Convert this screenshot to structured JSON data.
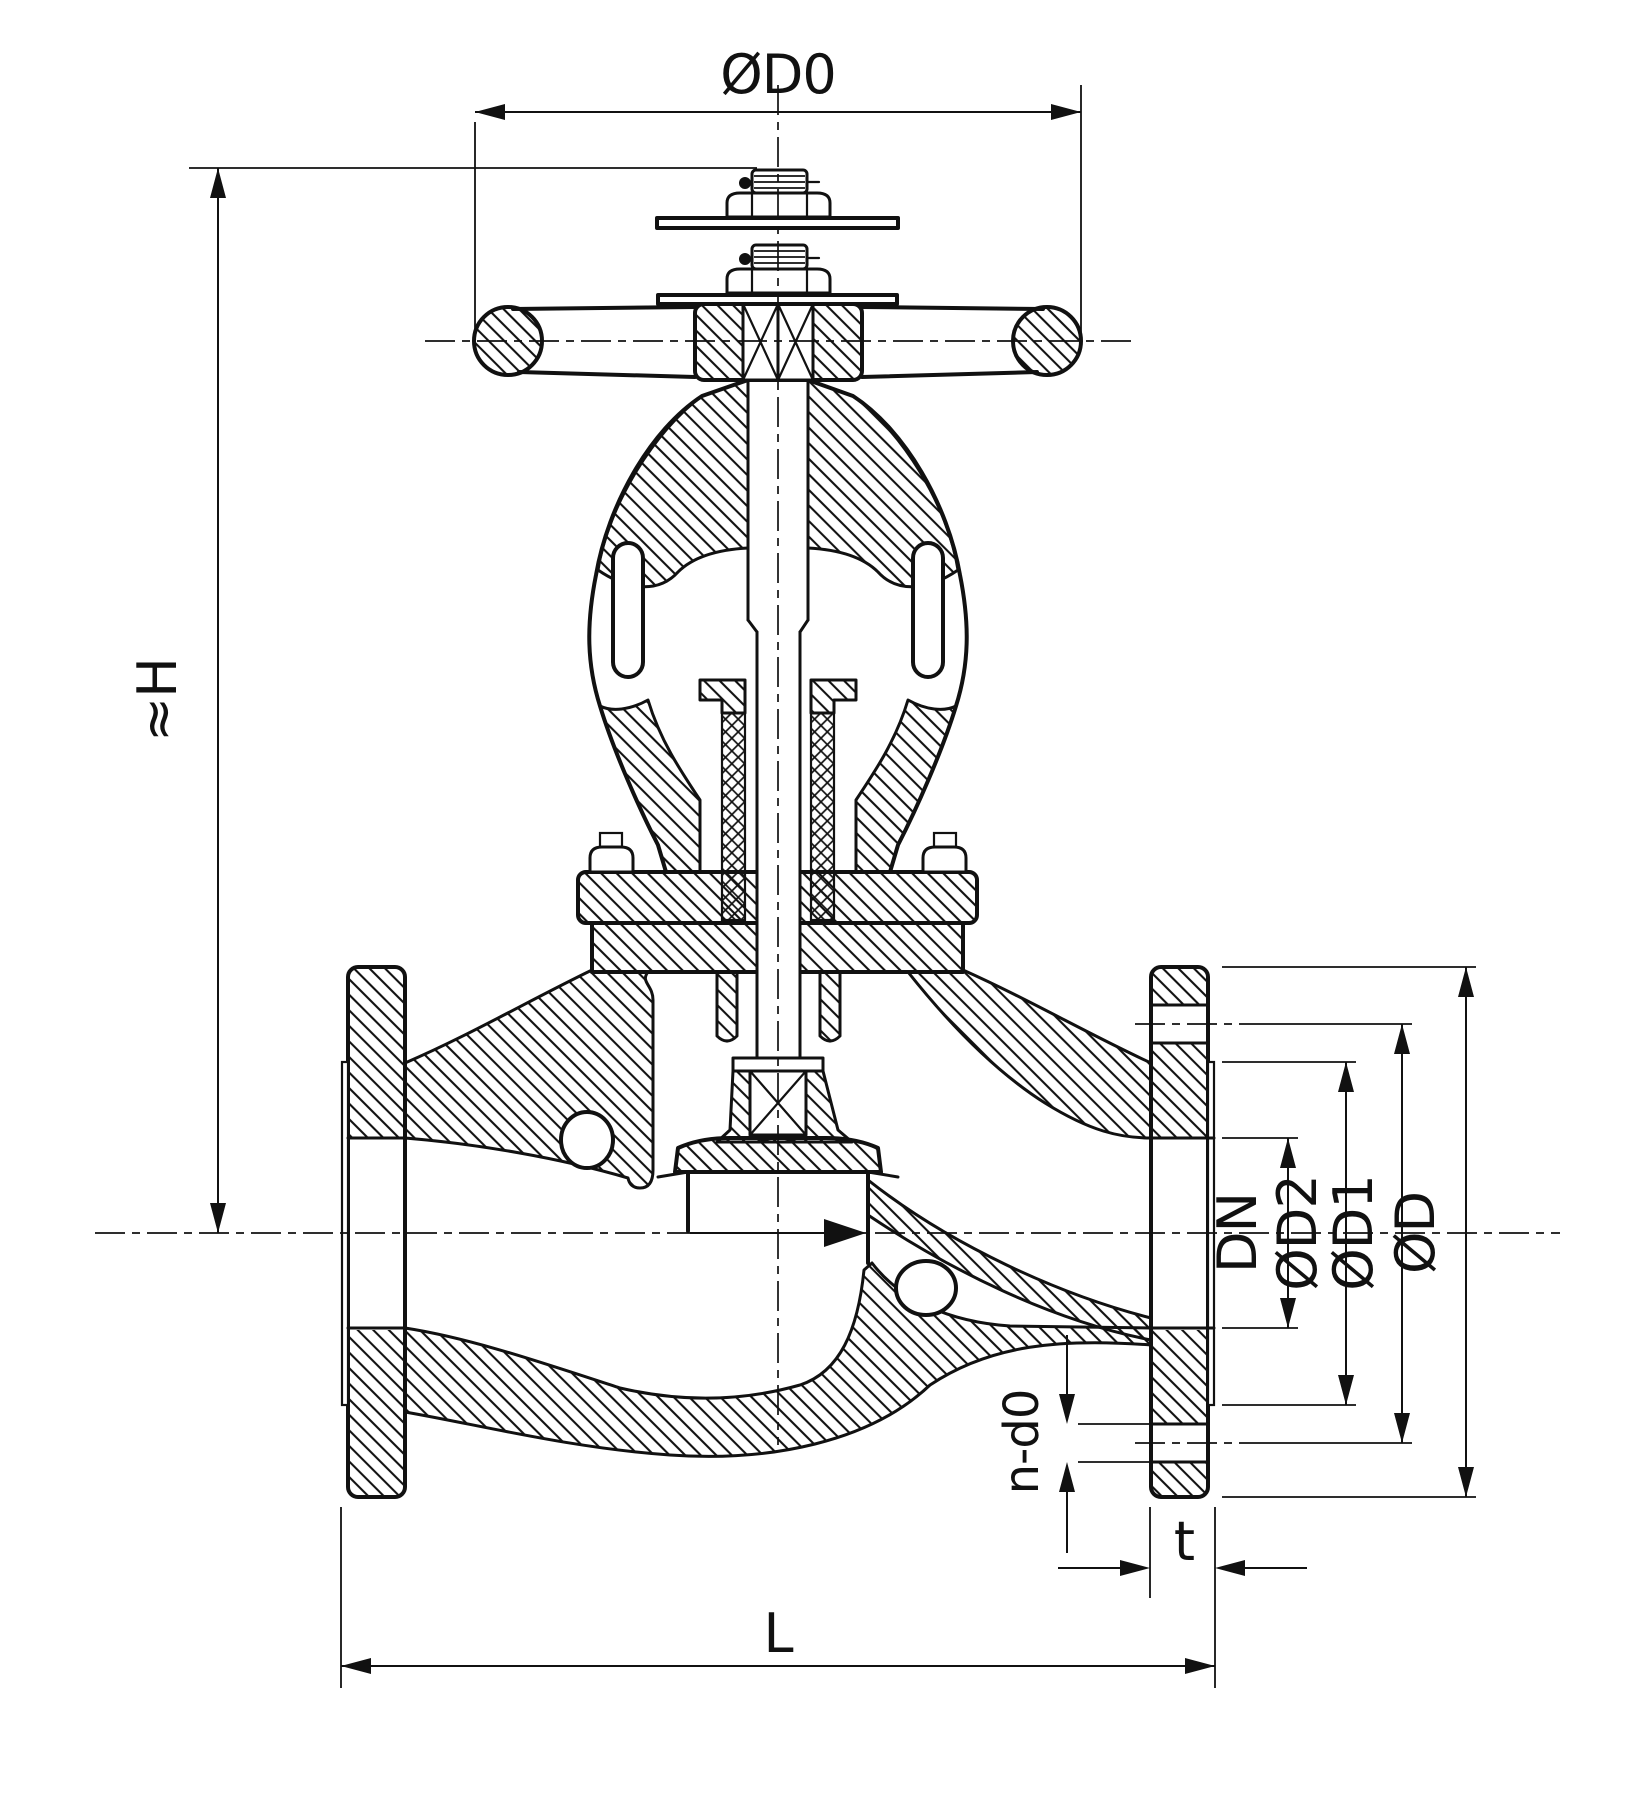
{
  "colors": {
    "ink": "#111111",
    "background": "#ffffff"
  },
  "dimensions": {
    "handwheel_diameter": {
      "label": "ØD0"
    },
    "height": {
      "label": "≈H"
    },
    "nominal_bore": {
      "label": "DN"
    },
    "raised_face_diameter": {
      "label": "ØD2"
    },
    "bolt_circle_diameter": {
      "label": "ØD1"
    },
    "flange_outer_diameter": {
      "label": "ØD"
    },
    "bolt_holes": {
      "label": "n-d0"
    },
    "flange_thickness": {
      "label": "t"
    },
    "face_to_face_length": {
      "label": "L"
    }
  }
}
